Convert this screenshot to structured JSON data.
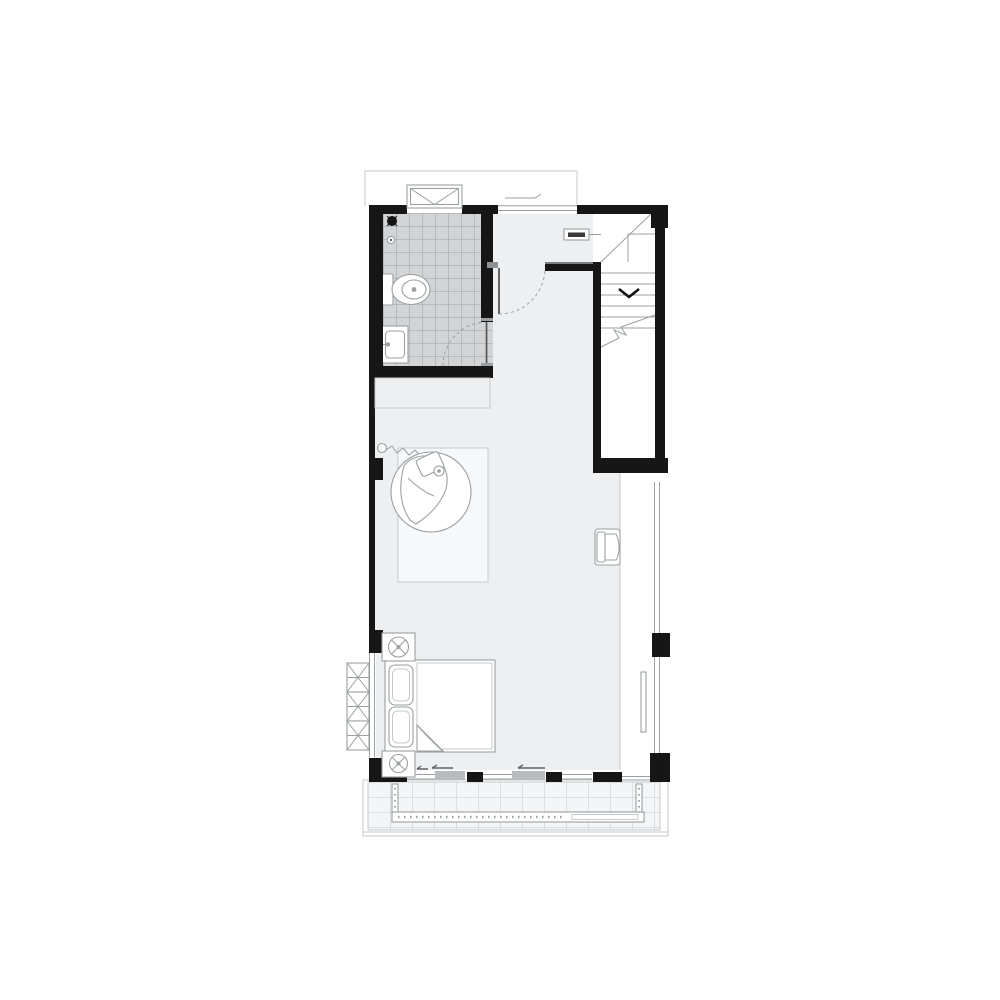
{
  "page": {
    "background": "#ffffff",
    "description_label": ""
  },
  "colors": {
    "wall": "#161616",
    "floor": "#edeff1",
    "tile": "#d2d4d6",
    "tile_line": "#909396",
    "line": "#9aa0a3",
    "line_light": "#c6c9cb",
    "line_dark": "#5f6468",
    "panel": "#b8bbbd",
    "deck": "#f4f5f6",
    "white": "#ffffff"
  },
  "stair_tag": {
    "text": ""
  },
  "plan": {
    "icon_names": [
      "roof-outline",
      "skylight-window-icon",
      "shower-drain-icon",
      "shower-control-icon",
      "toilet-icon",
      "vanity-sink-icon",
      "bathroom-door-arc",
      "hall-window",
      "hall-door-arc",
      "stair-treads",
      "stair-winder",
      "stair-down-arrow-icon",
      "stair-break-line",
      "stair-tag",
      "void-divider-line",
      "shelf-outline",
      "rug",
      "hanging-bubble-chair",
      "chain-anchor",
      "lounge-chair",
      "leaning-mirror",
      "bed",
      "pillow",
      "blanket-fold",
      "nightstand",
      "lamp-icon",
      "wardrobe-units",
      "left-window",
      "glass-curtain-wall",
      "sliding-door-panels",
      "slide-direction-arrows",
      "balcony-deck-grid",
      "deck-railing-planter"
    ]
  }
}
